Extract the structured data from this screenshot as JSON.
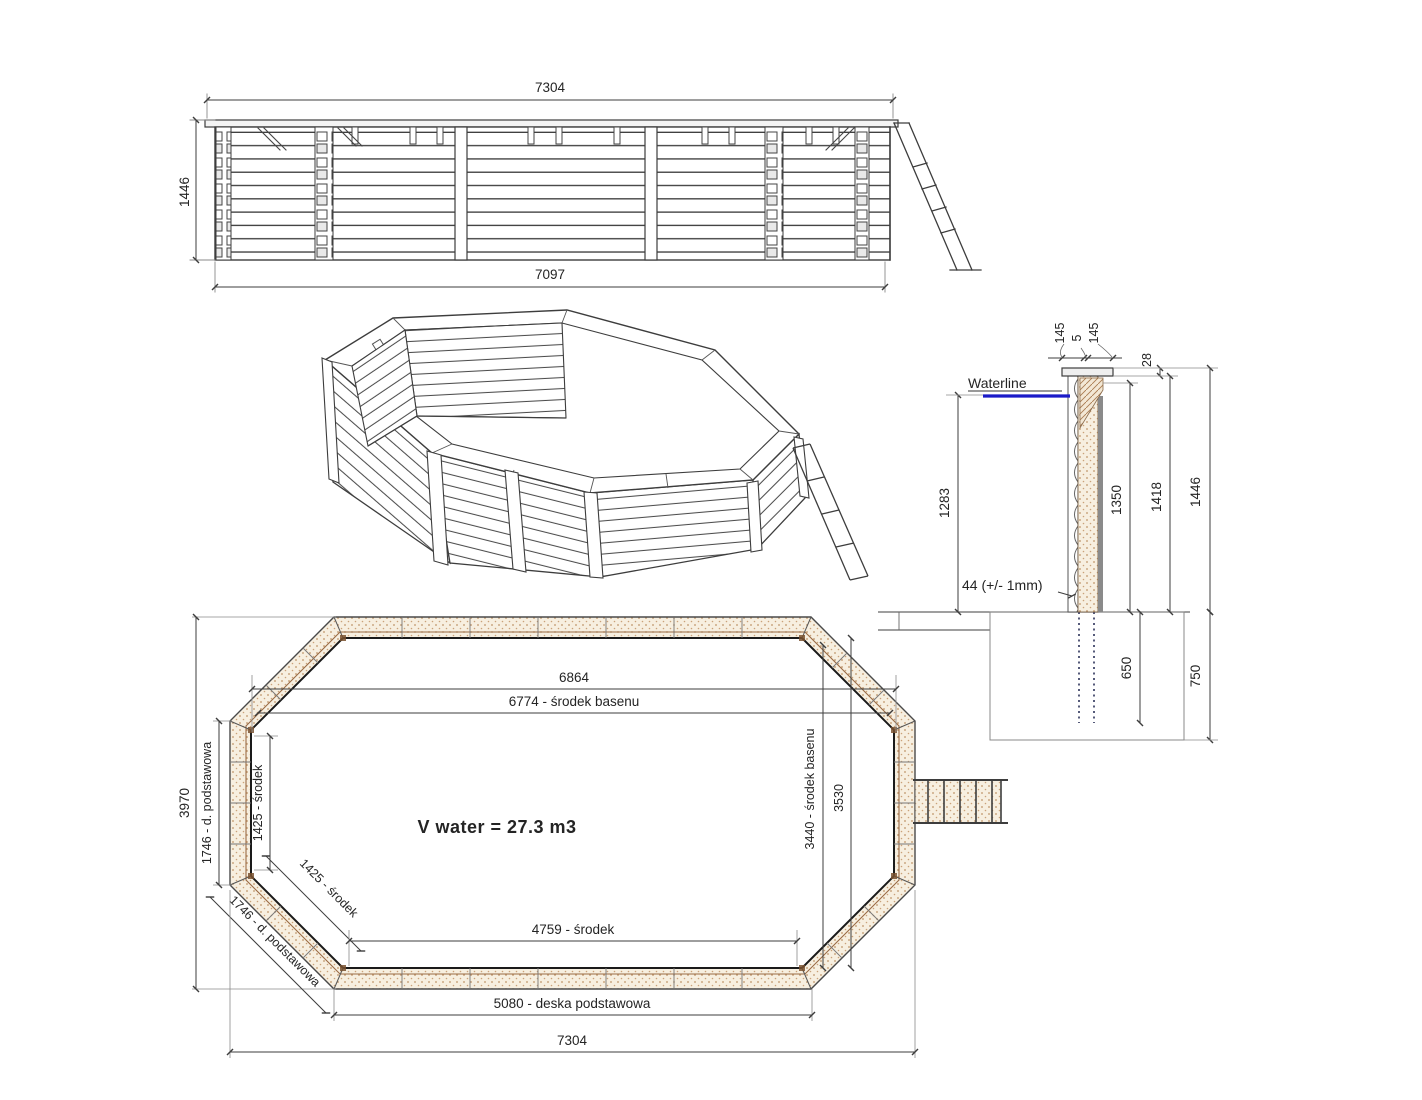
{
  "drawing_title": "Wooden octagonal pool technical drawing",
  "colors": {
    "line": "#3d3d3d",
    "light_line": "#8a8a8a",
    "wood_fill": "#f7efe0",
    "wood_dot": "#bf9468",
    "wood_stripe": "#9a6b45",
    "waterline_blue": "#1b1bc8",
    "liner_gray": "#8a8a8a"
  },
  "elevation": {
    "dim_width_top": "7304",
    "dim_width_bottom": "7097",
    "dim_height": "1446"
  },
  "section": {
    "waterline_label": "Waterline",
    "dim_cap_left": "145",
    "dim_cap_gap": "5",
    "dim_cap_right": "145",
    "dim_rim_drop": "28",
    "dim_water_height": "1283",
    "dim_inner_height": "1350",
    "dim_wall_height": "1418",
    "dim_total_height": "1446",
    "dim_base_board": "44 (+/- 1mm)",
    "dim_post_depth": "650",
    "dim_foundation_depth": "750"
  },
  "plan": {
    "volume_label": "V water = 27.3 m3",
    "dim_outer_length": "6864",
    "dim_center_length": "6774 - środek basenu",
    "dim_total_height": "3970",
    "dim_side_board": "1746 - d. podstawowa",
    "dim_side_center": "1425 - środek",
    "dim_diag_center": "1425 - środek",
    "dim_diag_board": "1746 - d. podstawowa",
    "dim_center_height": "3440 - środek basenu",
    "dim_inner_height": "3530",
    "dim_bottom_center": "4759 - środek",
    "dim_base_board": "5080 - deska podstawowa",
    "dim_total_length": "7304"
  }
}
